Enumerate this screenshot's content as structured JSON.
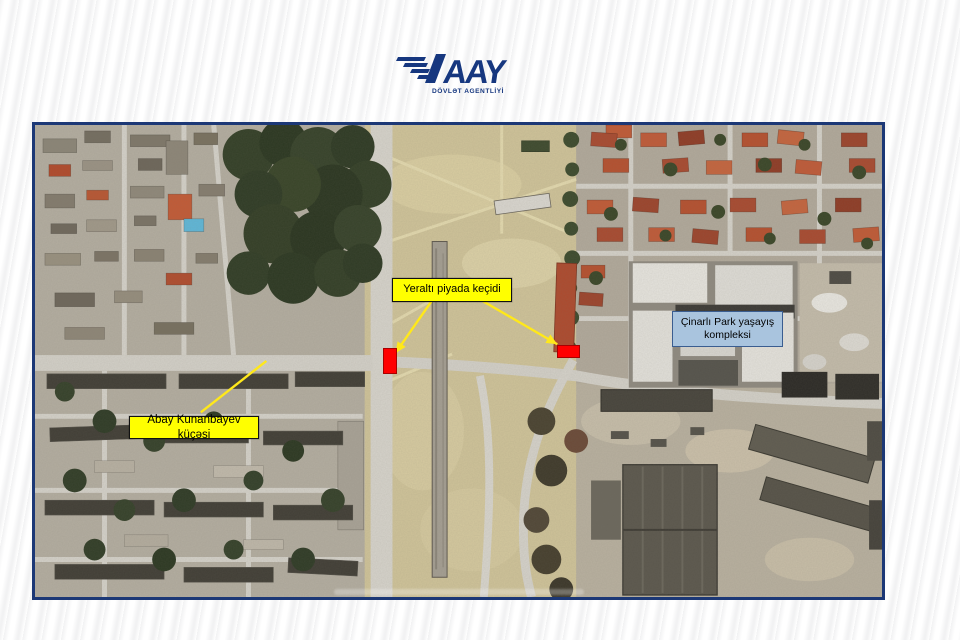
{
  "logo": {
    "acronym": "AAY",
    "subtitle": "DÖVLƏT AGENTLİYİ"
  },
  "map": {
    "labels": {
      "underpass": "Yeraltı piyada keçidi",
      "street": "Abay Kunanbayev küçəsi",
      "complex": "Çinarlı Park yaşayış kompleksi"
    },
    "colors": {
      "annotation_yellow": "#ffff00",
      "marker_red": "#ff0000",
      "complex_label_bg": "#a9c4de",
      "frame_border": "#1c3876",
      "logo_navy": "#16377f"
    }
  }
}
